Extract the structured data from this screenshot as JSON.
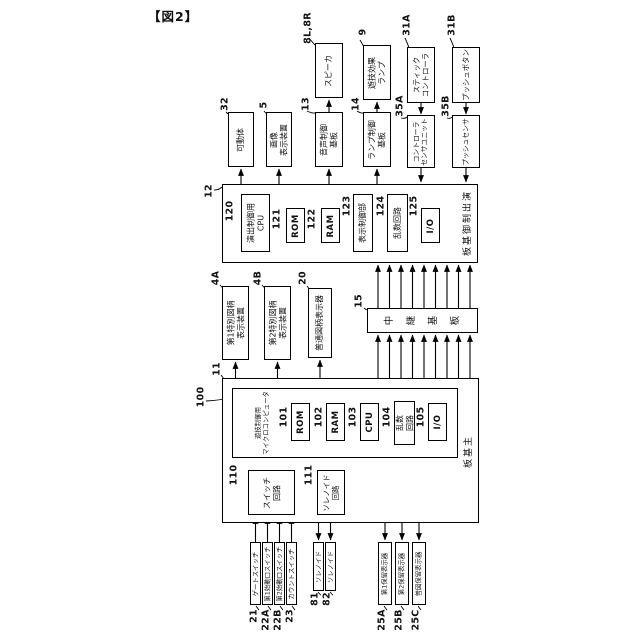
{
  "figure": {
    "title": "【図2】"
  },
  "blocks": {
    "speaker": {
      "num": "8L,8R",
      "label": "スピーカ"
    },
    "game_effect_lamp": {
      "num": "9",
      "label": "遊技効果\nランプ"
    },
    "stick_controller": {
      "num": "31A",
      "label": "スティック\nコントローラ"
    },
    "push_button": {
      "num": "31B",
      "label": "プッシュボタン"
    },
    "movable_body": {
      "num": "32",
      "label": "可動体"
    },
    "image_display": {
      "num": "5",
      "label": "画像\n表示装置"
    },
    "sound_board": {
      "num": "13",
      "label": "音声制御\n基板"
    },
    "lamp_board": {
      "num": "14",
      "label": "ランプ制御\n基板"
    },
    "controller_sensor": {
      "num": "35A",
      "label": "コントローラ\nセンサユニット"
    },
    "push_sensor": {
      "num": "35B",
      "label": "プッシュセンサ"
    },
    "effect_board": {
      "num": "12",
      "label": "演出制御基板"
    },
    "effect_cpu": {
      "num": "120",
      "label": "演出制御用\nCPU"
    },
    "effect_rom": {
      "num": "121",
      "label": "ROM"
    },
    "effect_ram": {
      "num": "122",
      "label": "RAM"
    },
    "display_ctrl": {
      "num": "123",
      "label": "表示制御部"
    },
    "effect_rand": {
      "num": "124",
      "label": "乱数回路"
    },
    "effect_io": {
      "num": "125",
      "label": "I/O"
    },
    "special1_display": {
      "num": "4A",
      "label": "第1特別図柄\n表示装置"
    },
    "special2_display": {
      "num": "4B",
      "label": "第2特別図柄\n表示装置"
    },
    "normal_display": {
      "num": "20",
      "label": "普通図柄表示器"
    },
    "relay_board": {
      "num": "15",
      "label": "中継基板"
    },
    "main_board": {
      "num": "11",
      "label": "主基板"
    },
    "game_micro": {
      "num": "100",
      "label": "遊技制御用\nマイクロコンピュータ"
    },
    "main_rom": {
      "num": "101",
      "label": "ROM"
    },
    "main_ram": {
      "num": "102",
      "label": "RAM"
    },
    "main_cpu": {
      "num": "103",
      "label": "CPU"
    },
    "main_rand": {
      "num": "104",
      "label": "乱数\n回路"
    },
    "main_io": {
      "num": "105",
      "label": "I/O"
    },
    "switch_circuit": {
      "num": "110",
      "label": "スイッチ\n回路"
    },
    "solenoid_circuit": {
      "num": "111",
      "label": "ソレノイド\n回路"
    },
    "gate_switch": {
      "num": "21",
      "label": "ゲートスイッチ"
    },
    "start1_switch": {
      "num": "22A",
      "label": "第1始動口スイッチ"
    },
    "start2_switch": {
      "num": "22B",
      "label": "第2始動口スイッチ"
    },
    "count_switch": {
      "num": "23",
      "label": "カウントスイッチ"
    },
    "solenoid_81": {
      "num": "81",
      "label": "ソレノイド"
    },
    "solenoid_82": {
      "num": "82",
      "label": "ソレノイド"
    },
    "hold1_display": {
      "num": "25A",
      "label": "第1保留表示器"
    },
    "hold2_display": {
      "num": "25B",
      "label": "第2保留表示器"
    },
    "normal_hold_display": {
      "num": "25C",
      "label": "普図保留表示器"
    }
  }
}
